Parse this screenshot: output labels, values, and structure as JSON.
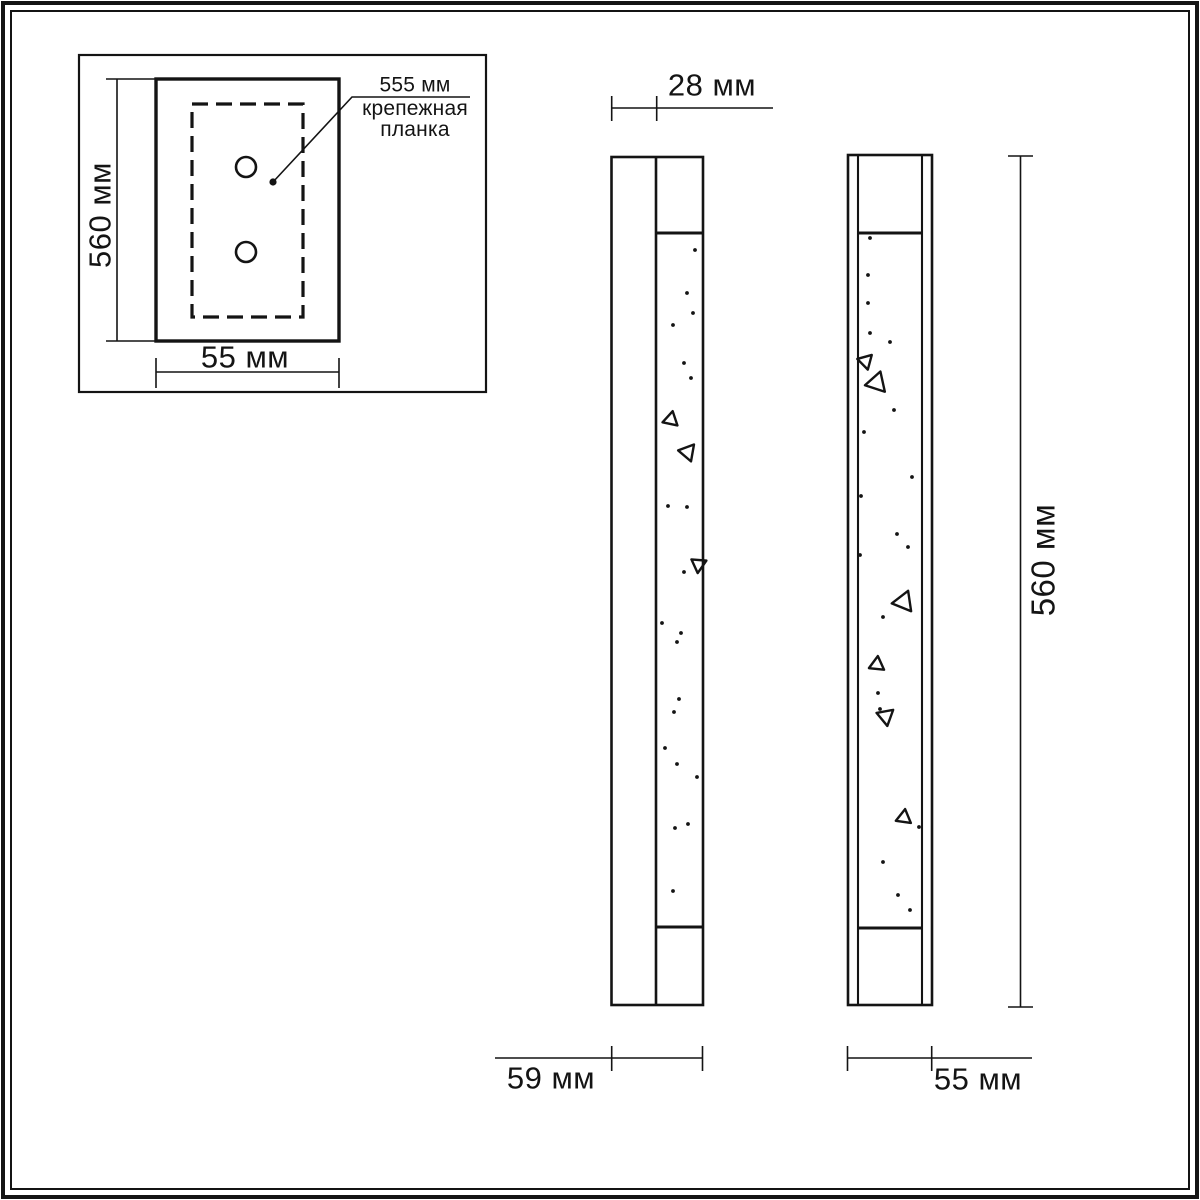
{
  "drawing": {
    "title": "wall-lamp-dimension-drawing",
    "unit": "мм"
  },
  "colors": {
    "line": "#141414",
    "background": "#ffffff"
  },
  "labels": {
    "inset_height": "560 мм",
    "inset_width": "55 мм",
    "plate_length": "555 мм",
    "plate_name_line1": "крепежная",
    "plate_name_line2": "планка",
    "side_depth_top": "28 мм",
    "side_depth_total": "59 мм",
    "front_width": "55 мм",
    "front_height": "560 мм"
  },
  "sparkles": {
    "middle_dots": [
      {
        "x": 695,
        "y": 250
      },
      {
        "x": 687,
        "y": 293
      },
      {
        "x": 693,
        "y": 313
      },
      {
        "x": 673,
        "y": 325
      },
      {
        "x": 684,
        "y": 363
      },
      {
        "x": 691,
        "y": 378
      },
      {
        "x": 668,
        "y": 506
      },
      {
        "x": 687,
        "y": 507
      },
      {
        "x": 684,
        "y": 572
      },
      {
        "x": 662,
        "y": 623
      },
      {
        "x": 681,
        "y": 633
      },
      {
        "x": 677,
        "y": 642
      },
      {
        "x": 679,
        "y": 699
      },
      {
        "x": 674,
        "y": 712
      },
      {
        "x": 665,
        "y": 748
      },
      {
        "x": 677,
        "y": 764
      },
      {
        "x": 697,
        "y": 777
      },
      {
        "x": 688,
        "y": 824
      },
      {
        "x": 675,
        "y": 828
      },
      {
        "x": 673,
        "y": 891
      }
    ],
    "middle_triangles": [
      {
        "x": 671,
        "y": 419,
        "s": 8,
        "r": 12
      },
      {
        "x": 687,
        "y": 452,
        "s": 9,
        "r": -80
      },
      {
        "x": 698,
        "y": 564,
        "s": 8,
        "r": -55
      }
    ],
    "right_dots": [
      {
        "x": 870,
        "y": 238
      },
      {
        "x": 868,
        "y": 275
      },
      {
        "x": 868,
        "y": 303
      },
      {
        "x": 870,
        "y": 333
      },
      {
        "x": 890,
        "y": 342
      },
      {
        "x": 894,
        "y": 410
      },
      {
        "x": 864,
        "y": 432
      },
      {
        "x": 912,
        "y": 477
      },
      {
        "x": 861,
        "y": 496
      },
      {
        "x": 897,
        "y": 534
      },
      {
        "x": 908,
        "y": 547
      },
      {
        "x": 860,
        "y": 555
      },
      {
        "x": 883,
        "y": 617
      },
      {
        "x": 878,
        "y": 693
      },
      {
        "x": 880,
        "y": 709
      },
      {
        "x": 919,
        "y": 827
      },
      {
        "x": 883,
        "y": 862
      },
      {
        "x": 898,
        "y": 895
      },
      {
        "x": 910,
        "y": 910
      }
    ],
    "right_triangles": [
      {
        "x": 865,
        "y": 361,
        "s": 8,
        "r": -75
      },
      {
        "x": 877,
        "y": 382,
        "s": 11,
        "r": 18
      },
      {
        "x": 904,
        "y": 601,
        "s": 11,
        "r": 22
      },
      {
        "x": 877,
        "y": 664,
        "s": 8,
        "r": 6
      },
      {
        "x": 885,
        "y": 716,
        "s": 9,
        "r": -70
      },
      {
        "x": 904,
        "y": 817,
        "s": 8,
        "r": 8
      }
    ]
  }
}
